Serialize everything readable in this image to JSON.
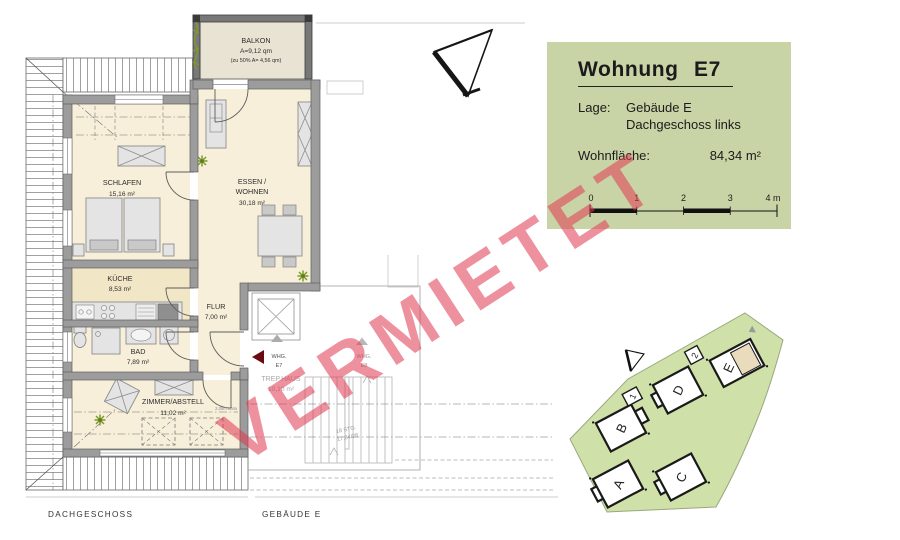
{
  "watermark": {
    "text": "VERMIETET"
  },
  "info_box": {
    "title": "Wohnung E7",
    "lage_label": "Lage:",
    "lage_line1": "Gebäude E",
    "lage_line2": "Dachgeschoss links",
    "area_label": "Wohnfläche:",
    "area_value": "84,34 m²",
    "scale_ticks": {
      "t0": "0",
      "t1": "1",
      "t2": "2",
      "t3": "3",
      "t4": "4 m"
    }
  },
  "plan": {
    "balkon_name": "BALKON",
    "balkon_area": "A=9,12 qm",
    "balkon_note": "(zu 50% A= 4,56 qm)",
    "schlafen_name": "SCHLAFEN",
    "schlafen_area": "15,16 m²",
    "essen_name1": "ESSEN /",
    "essen_name2": "WOHNEN",
    "essen_area": "30,18 m²",
    "kueche_name": "KÜCHE",
    "kueche_area": "8,53 m²",
    "bad_name": "BAD",
    "bad_area": "7,89 m²",
    "flur_name": "FLUR",
    "flur_area": "7,00 m²",
    "zimmer_name": "ZIMMER/ABSTELL",
    "zimmer_area": "11,02 m²",
    "trephaus_name": "TREP.HAUS",
    "trephaus_area": "10,10 m²",
    "whg_e7_line1": "WHG.",
    "whg_e7_line2": "E7",
    "whg_e8_line1": "WHG.",
    "whg_e8_line2": "E8",
    "stairs_line1": "18 STG.",
    "stairs_line2": "17,84/28",
    "lima_note": "2,00m LiMa",
    "footer_left": "DACHGESCHOSS",
    "footer_right": "GEBÄUDE E"
  },
  "siteplan": {
    "building_a": "A",
    "building_b": "B",
    "building_c": "C",
    "building_d": "D",
    "building_e": "E",
    "marker_1": "1",
    "marker_2": "2"
  },
  "colors": {
    "info_box_bg": "#c9d4a6",
    "site_green": "#cfe0a8",
    "floor_cream": "#f7efd9",
    "wall_grey": "#9c9c9c",
    "watermark_pink": "#e03650",
    "unit_highlight": "#e9dcbc",
    "entry_arrow_red": "#6d0a10"
  }
}
